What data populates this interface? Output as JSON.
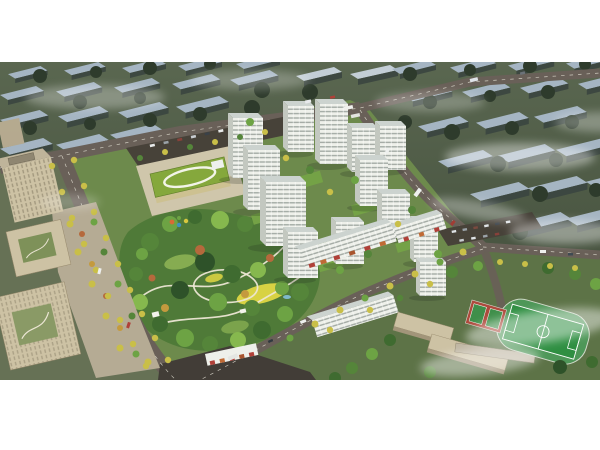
{
  "image": {
    "description": "Aerial architectural rendering of a planned residential community: a cluster of white high-rise apartment towers around a large landscaped central park with winding white paths and a yellow lawn, a kindergarten with a green roof and white loop motif, beige office buildings on the left, a school campus with green sports field and red basketball courts on the lower right, tree-lined boulevards with yellow street trees, dark asphalt roads with cars and buses, parking lots, and hazy desaturated rows of existing city slab blocks fading into white mist in the background."
  },
  "scene": {
    "background_city": "hazy rows of existing residential slab blocks",
    "kindergarten": "green-roofed kindergarten with white loop rooftop motif",
    "residential_towers": "white high-rise apartment towers",
    "central_park": "landscaped park with paths, lawns and pavilions",
    "office_complex": "beige office buildings with courtyards",
    "school_campus": "school buildings with connecting corridor",
    "sports_field": "green pitch with running track and red courts",
    "roads": "boulevards and access roads with street trees",
    "fog": "white mist wisps over the city"
  },
  "palette": {
    "bg-ground": "#4b5844",
    "bg-slab-roof": "#a9b9c8",
    "bg-slab-face": "#3c4741",
    "tree-dark": "#2d3a2b",
    "site-green": "#6d8a4c",
    "park-green": "#4f7a38",
    "road": "#696058",
    "road-dark": "#423d37",
    "tower-face": "#eef0ea",
    "tower-roof": "#ccd3cf",
    "beige": "#cdc2a4",
    "kinder-roof": "#85a83c",
    "field-green": "#2f8f42",
    "court-red": "#ad4a3c",
    "yellow-tree": "#c9bf48",
    "lawn-yellow": "#d8d243",
    "path-white": "#ece6d4",
    "plaza": "#b5ab94"
  }
}
